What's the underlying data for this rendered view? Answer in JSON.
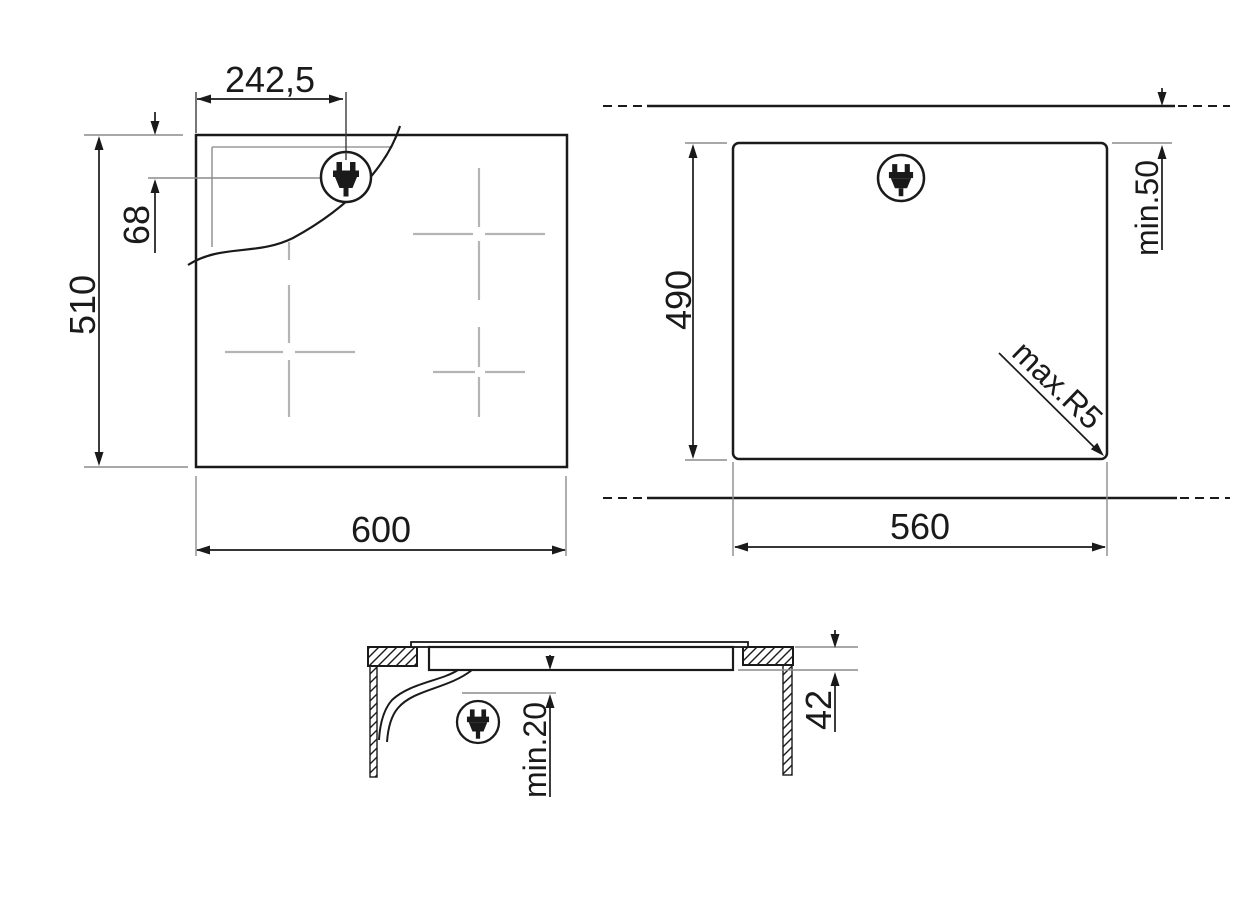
{
  "labels": {
    "top_width": "600",
    "top_height": "510",
    "plug_offset_x": "242,5",
    "plug_offset_y": "68",
    "cutout_width": "560",
    "cutout_height": "490",
    "rear_clearance": "min.50",
    "corner_radius": "max.R5",
    "build_in_depth": "42",
    "bottom_clearance": "min.20"
  },
  "icons": {
    "plug": "power-plug-icon"
  },
  "colors": {
    "line": "#1a1a1a",
    "extension": "#8c8c8c",
    "zone_marker": "#b4b4b4",
    "background": "#ffffff"
  }
}
